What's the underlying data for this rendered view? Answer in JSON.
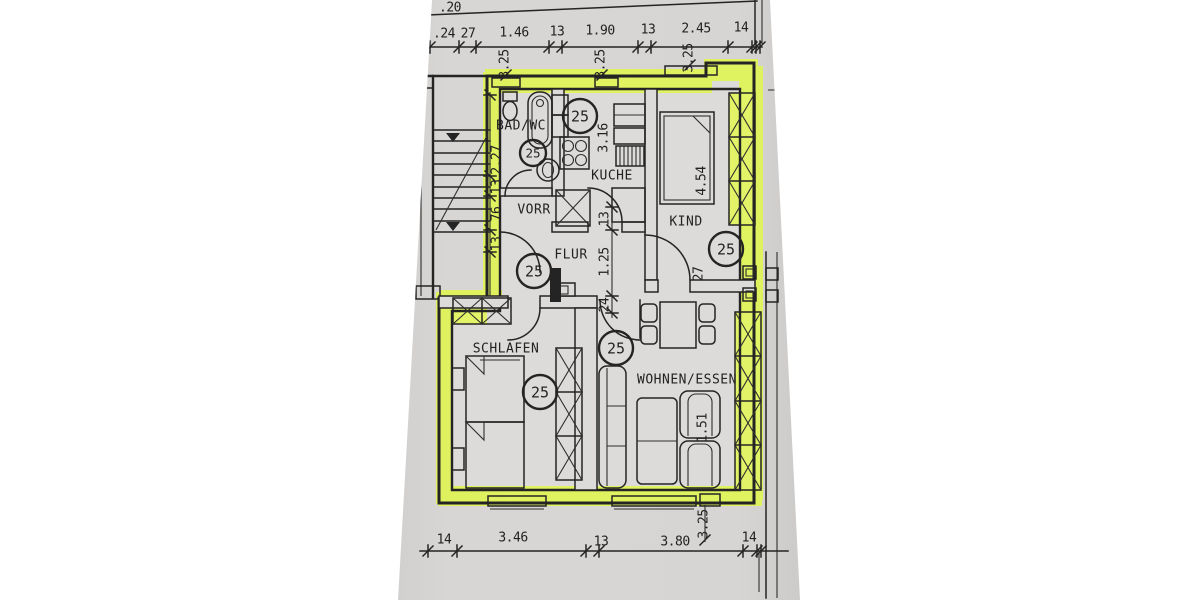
{
  "unit": {
    "number": "25"
  },
  "rooms": {
    "bad": "BAD/WC",
    "kueche": "KUCHE",
    "vorr": "VORR",
    "flur": "FLUR",
    "kind": "KIND",
    "schlafen": "SCHLAFEN",
    "wohnen": "WOHNEN/ESSEN"
  },
  "dims": {
    "top": [
      ".24",
      "27",
      "1.46",
      "13",
      "1.90",
      "13",
      "2.45",
      "14"
    ],
    "top_partial": ".20",
    "bottom": [
      "14",
      "3.46",
      "13",
      "3.80",
      "14"
    ],
    "left_chain": [
      "2.27",
      "13",
      "76",
      "13"
    ],
    "flur_chain": [
      "13",
      "1.25",
      "24"
    ],
    "kueche_depth": "3.16",
    "kind_length": "4.54",
    "kind_wall": "27",
    "wohnen_width": "1.51",
    "axis": [
      "3.25",
      "3.25",
      "3.25",
      "3.25"
    ]
  },
  "colors": {
    "highlight": "#e0f455",
    "paper": "#d6d4d2",
    "ink": "#242424",
    "background": "#ffffff"
  }
}
